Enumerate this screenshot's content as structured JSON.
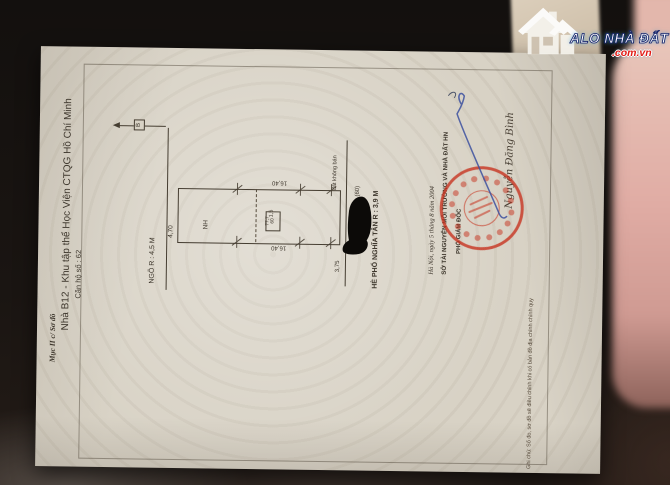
{
  "brand": {
    "name": "ALO NHÀ ĐẤT",
    "domain": ".com.vn",
    "icon": "house-logo-icon",
    "text_color": "#ffffff",
    "outline_color": "#16246b",
    "domain_color": "#e21b15"
  },
  "document": {
    "header": {
      "section_label": "Mục II c/ Sơ đồ",
      "title": "Nhà B12 - Khu tập thể Học Viện CTQG Hồ Chí Minh",
      "subtitle": "Căn hộ số : 62"
    },
    "diagram": {
      "north_label": "B",
      "alley_label": "NGÕ R : 4,5 M",
      "street_label": "HÈ PHỐ NGHĨA TÂN R : 3,9 M",
      "small_note": "đất không bán",
      "house_abbr": "NH",
      "house_number": "(60)",
      "parcel_number": "60",
      "parcel_area": "77,7",
      "dims": {
        "length": "16,40",
        "width": "4,70",
        "offset": "1,5",
        "front": "3,75"
      }
    },
    "signoff": {
      "date_line": "Hà Nội, ngày 5 tháng 8 năm 2004",
      "agency": "SỞ TÀI NGUYÊN MÔI TRƯỜNG VÀ NHÀ ĐẤT HN",
      "role": "PHÓ GIÁM ĐỐC",
      "signer": "Nguyễn Đăng Bình",
      "stamp_color": "#c6301c",
      "ink_color": "#3c509f"
    },
    "footnote": "Ghi chú: Số đo, sơ đồ sẽ điều chỉnh khi có bản đồ địa chính chính quy"
  }
}
